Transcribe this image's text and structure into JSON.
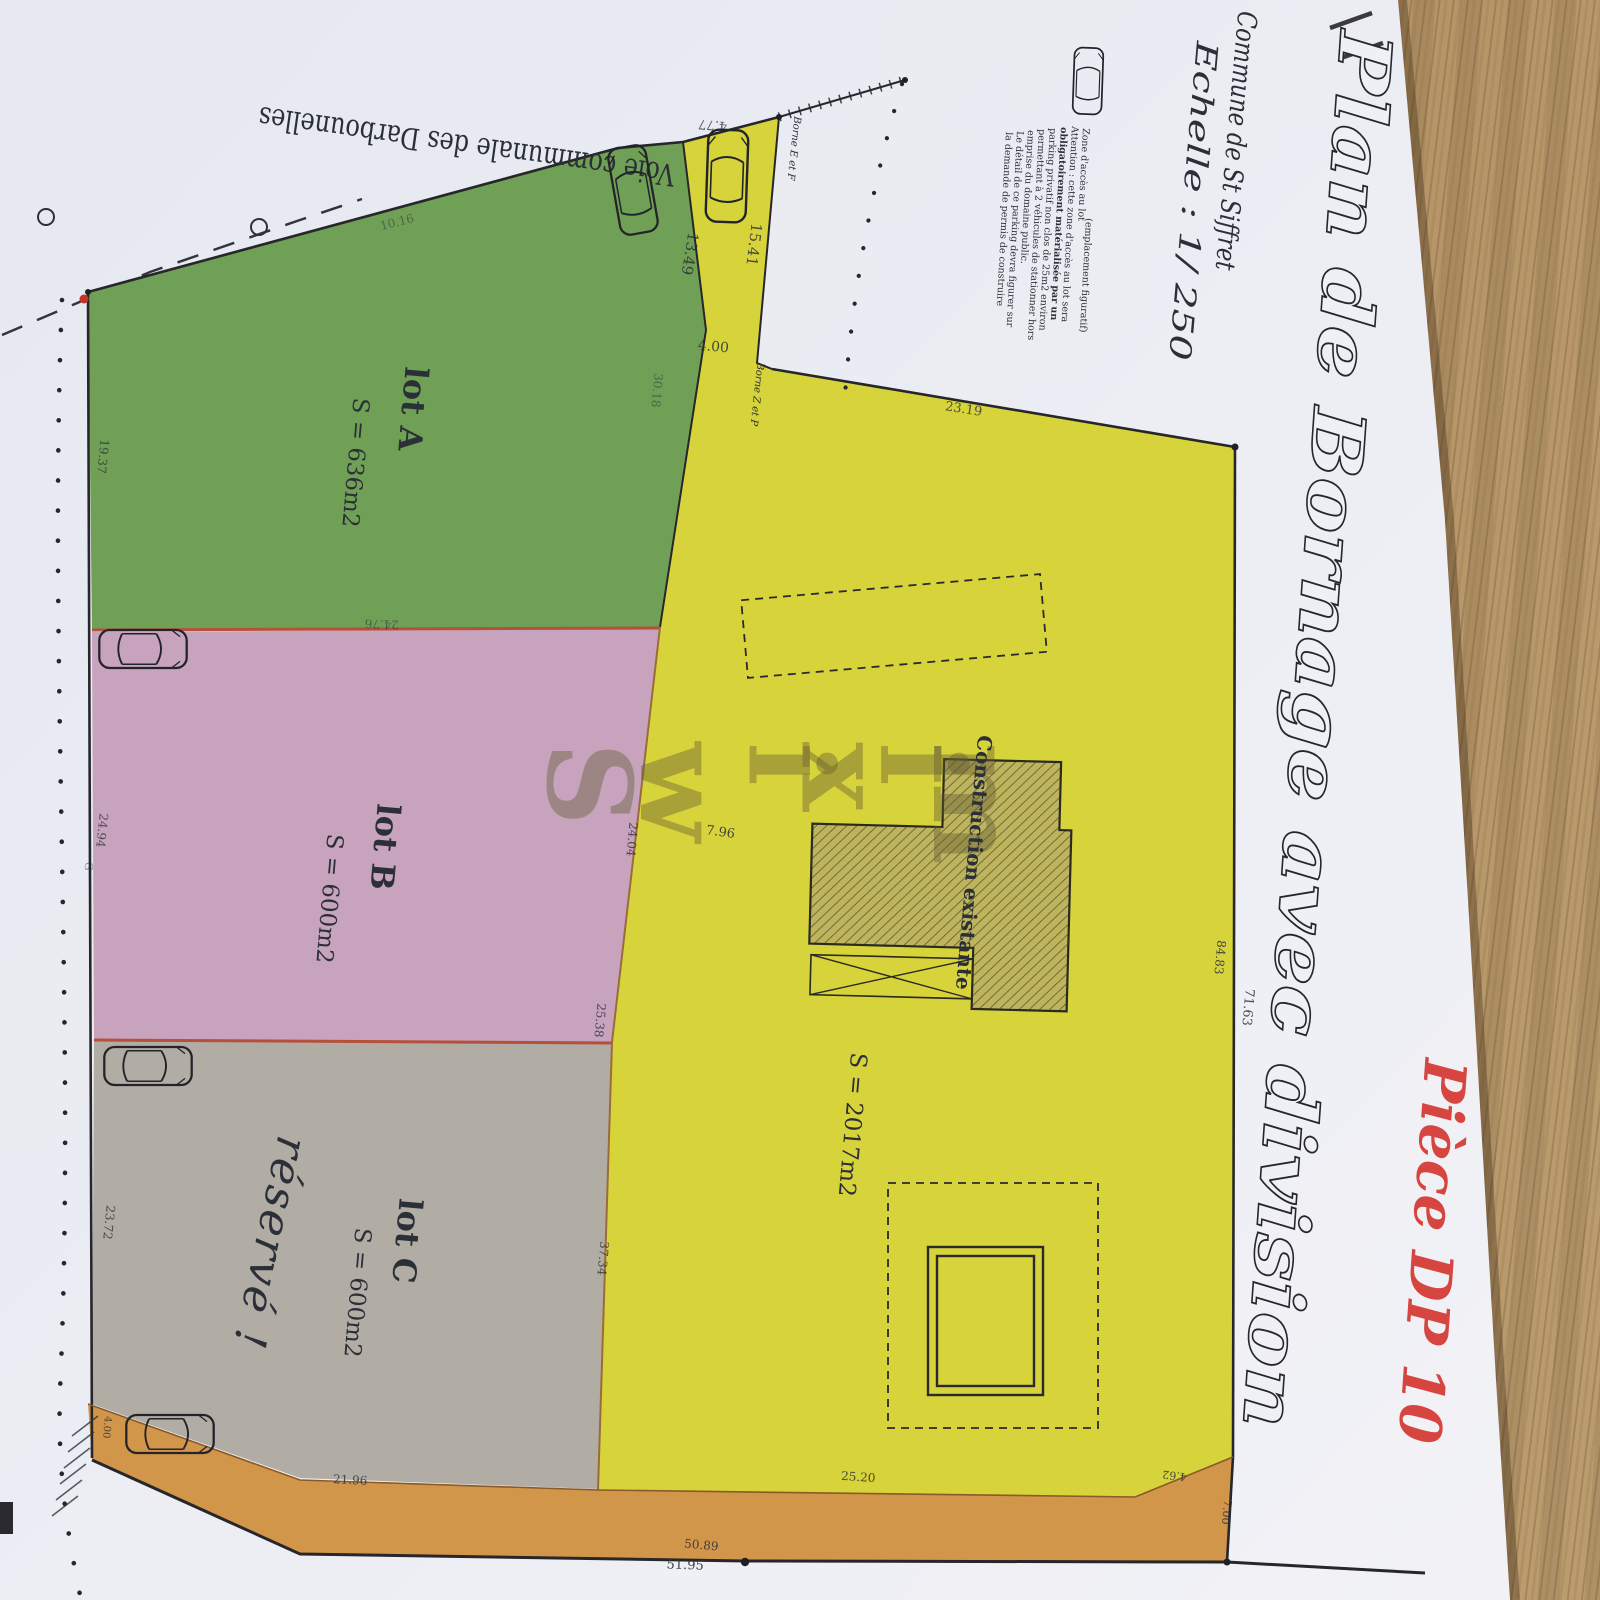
{
  "title_block": {
    "title": "Plan de Bornage avec division",
    "piece": "Pièce DP 10",
    "commune": "Commune de St Siffret",
    "echelle": "Echelle : 1/ 250"
  },
  "road_label": "Voie communale des Darbounelles",
  "watermark": "Swixim",
  "legend": {
    "lines": [
      {
        "t": "Zone d'accès au lot",
        "x": 1083,
        "y": 128
      },
      {
        "t": "(emplacement figuratif)",
        "x": 1086,
        "y": 218,
        "c": "#c4706b"
      },
      {
        "t": "Attention : cette zone d'accès au lot sera",
        "x": 1072,
        "y": 126
      },
      {
        "t": "obligatoirement matérialisée par un",
        "x": 1061,
        "y": 127,
        "b": 1
      },
      {
        "t": "parking privatif non clos de 25m2 environ",
        "x": 1050,
        "y": 128
      },
      {
        "t": "permettant à 2 véhicules de stationner hors",
        "x": 1039,
        "y": 129
      },
      {
        "t": "emprise du domaine public.",
        "x": 1028,
        "y": 130
      },
      {
        "t": "Le détail de ce parking devra figurer sur",
        "x": 1017,
        "y": 131
      },
      {
        "t": "la demande de permis de construire",
        "x": 1006,
        "y": 132
      }
    ]
  },
  "lot_labels": [
    {
      "t": "lot A",
      "x": 402,
      "y": 408,
      "s": 32,
      "b": 1
    },
    {
      "t": "S = 636m2",
      "x": 348,
      "y": 462,
      "s": 23
    },
    {
      "t": "lot B",
      "x": 374,
      "y": 846,
      "s": 32,
      "b": 1
    },
    {
      "t": "S = 600m2",
      "x": 322,
      "y": 898,
      "s": 23
    },
    {
      "t": "lot C",
      "x": 396,
      "y": 1240,
      "s": 32,
      "b": 1
    },
    {
      "t": "S = 600m2",
      "x": 350,
      "y": 1292,
      "s": 23
    },
    {
      "t": "S = 2017m2",
      "x": 845,
      "y": 1124,
      "s": 23
    },
    {
      "t": "Construction existante",
      "x": 967,
      "y": 862,
      "s": 20,
      "b": 1
    },
    {
      "t": "réservé !",
      "x": 256,
      "y": 1240,
      "s": 44,
      "hw": 1
    }
  ],
  "bornes": [
    {
      "t": "Borne E et F",
      "x": 791,
      "y": 148
    },
    {
      "t": "Borne Z et P",
      "x": 754,
      "y": 394
    }
  ],
  "dimensions": [
    {
      "t": "4.77",
      "x": 713,
      "y": 121,
      "r": 185,
      "s": 13,
      "o": 0.8
    },
    {
      "t": "15.41",
      "x": 749,
      "y": 244,
      "r": 97,
      "s": 15,
      "o": 0.85
    },
    {
      "t": "13.49",
      "x": 685,
      "y": 253,
      "r": 99,
      "s": 15,
      "o": 0.85
    },
    {
      "t": "4.00",
      "x": 713,
      "y": 351,
      "r": 5,
      "s": 14,
      "o": 0.85
    },
    {
      "t": "23.19",
      "x": 963,
      "y": 413,
      "r": 9,
      "s": 13,
      "o": 0.8
    },
    {
      "t": "10.16",
      "x": 398,
      "y": 226,
      "r": -14,
      "s": 12,
      "o": 0.5
    },
    {
      "t": "30.18",
      "x": 653,
      "y": 390,
      "r": 95,
      "s": 12,
      "o": 0.5
    },
    {
      "t": "24.76",
      "x": 382,
      "y": 620,
      "r": 182,
      "s": 12,
      "o": 0.55
    },
    {
      "t": "19.37",
      "x": 99,
      "y": 456,
      "r": 96,
      "s": 12,
      "o": 0.75
    },
    {
      "t": "24.94",
      "x": 98,
      "y": 830,
      "r": 96,
      "s": 12,
      "o": 0.75
    },
    {
      "t": "G",
      "x": 85,
      "y": 866,
      "r": 95,
      "s": 11,
      "o": 0.5
    },
    {
      "t": "23.72",
      "x": 105,
      "y": 1222,
      "r": 96,
      "s": 12,
      "o": 0.8
    },
    {
      "t": "4.00",
      "x": 104,
      "y": 1427,
      "r": 95,
      "s": 10,
      "o": 0.8
    },
    {
      "t": "24.04",
      "x": 628,
      "y": 839,
      "r": 95,
      "s": 12,
      "o": 0.8
    },
    {
      "t": "7.96",
      "x": 720,
      "y": 836,
      "r": 8,
      "s": 13,
      "o": 0.85
    },
    {
      "t": "25.38",
      "x": 596,
      "y": 1020,
      "r": 95,
      "s": 12,
      "o": 0.8
    },
    {
      "t": "37.34",
      "x": 599,
      "y": 1258,
      "r": 95,
      "s": 12,
      "o": 0.8
    },
    {
      "t": "84.83",
      "x": 1216,
      "y": 957,
      "r": 95,
      "s": 12,
      "o": 0.85
    },
    {
      "t": "71.63",
      "x": 1244,
      "y": 1007,
      "r": 95,
      "s": 13,
      "o": 0.85
    },
    {
      "t": "7.00",
      "x": 1223,
      "y": 1512,
      "r": 95,
      "s": 11,
      "o": 0.85
    },
    {
      "t": "4.62",
      "x": 1175,
      "y": 1472,
      "r": 187,
      "s": 11,
      "o": 0.85
    },
    {
      "t": "25.20",
      "x": 858,
      "y": 1481,
      "r": 4,
      "s": 12,
      "o": 0.85
    },
    {
      "t": "21.96",
      "x": 350,
      "y": 1484,
      "r": 3,
      "s": 12,
      "o": 0.8
    },
    {
      "t": "50.89",
      "x": 701,
      "y": 1549,
      "r": 5,
      "s": 12,
      "o": 0.85
    },
    {
      "t": "51.95",
      "x": 685,
      "y": 1569,
      "r": 2,
      "s": 13,
      "o": 0.9
    }
  ],
  "cars": [
    {
      "x": 1088,
      "y": 81,
      "r": 2,
      "s": 0.72
    },
    {
      "x": 727,
      "y": 176,
      "r": 2,
      "s": 1.0
    },
    {
      "x": 633,
      "y": 190,
      "r": -10,
      "s": 0.95
    },
    {
      "x": 143,
      "y": 649,
      "r": 90,
      "s": 0.95
    },
    {
      "x": 148,
      "y": 1066,
      "r": 90,
      "s": 0.95
    },
    {
      "x": 170,
      "y": 1434,
      "r": 90,
      "s": 0.95
    }
  ],
  "colors": {
    "lot_a_green": "#6fa055",
    "lot_b_pink": "#c7a3bd",
    "lot_c_gray": "#b2ada4",
    "parcel_yellow": "#d7d33b",
    "strip_orange": "#d2964a",
    "red_boundary": "#b5503a",
    "title_red": "#d6453f",
    "paper": "#eceef4",
    "wood": "#b3945f",
    "ink": "#26262b"
  }
}
